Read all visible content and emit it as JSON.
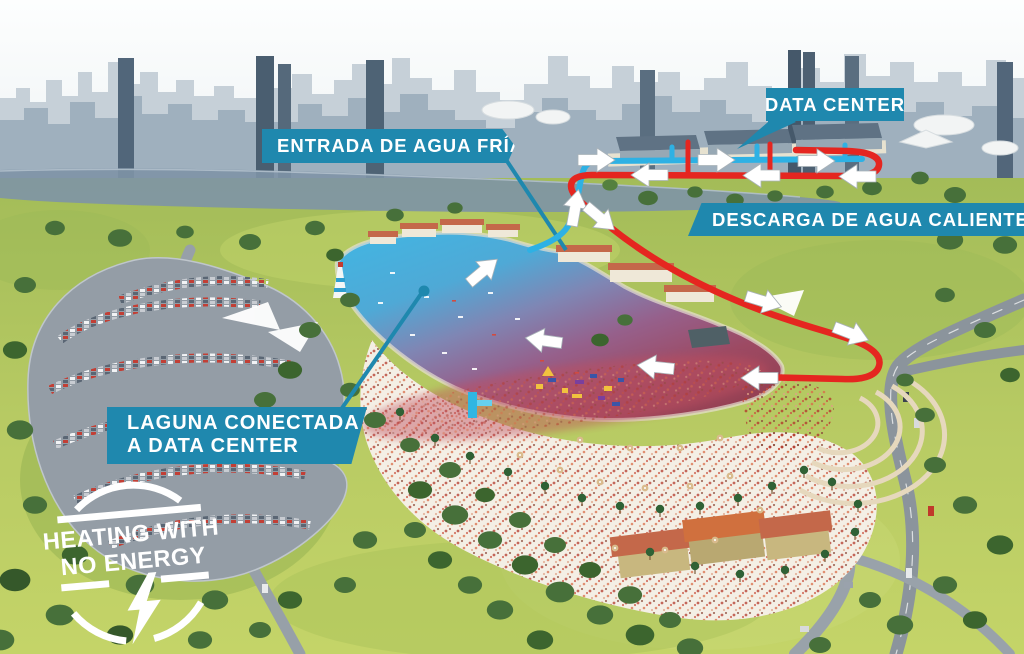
{
  "page": {
    "description": "Aerial rendering infographic: recreational lagoon connected to a data center, cold water intake and hot water discharge loop",
    "width": 1024,
    "height": 654
  },
  "labels": {
    "cold_water_inlet": "ENTRADA DE AGUA FRÍA",
    "data_center": "DATA CENTER",
    "hot_water_discharge": "DESCARGA DE AGUA CALIENTE",
    "lagoon_line1": "LAGUNA CONECTADA",
    "lagoon_line2": "A DATA CENTER"
  },
  "logo": {
    "line1": "HEATING WITH",
    "line2": "NO ENERGY",
    "icon": "lightning-bolt"
  },
  "colors": {
    "label_background": "#1f88ae",
    "cold_pipe": "#2eb1e4",
    "hot_pipe": "#e52620",
    "flow_arrow": "#ffffff",
    "lagoon_cold": "#41b6e3",
    "lagoon_warm": "#9b4455",
    "grass": "#b7ca63",
    "sand": "#f4efe5"
  }
}
